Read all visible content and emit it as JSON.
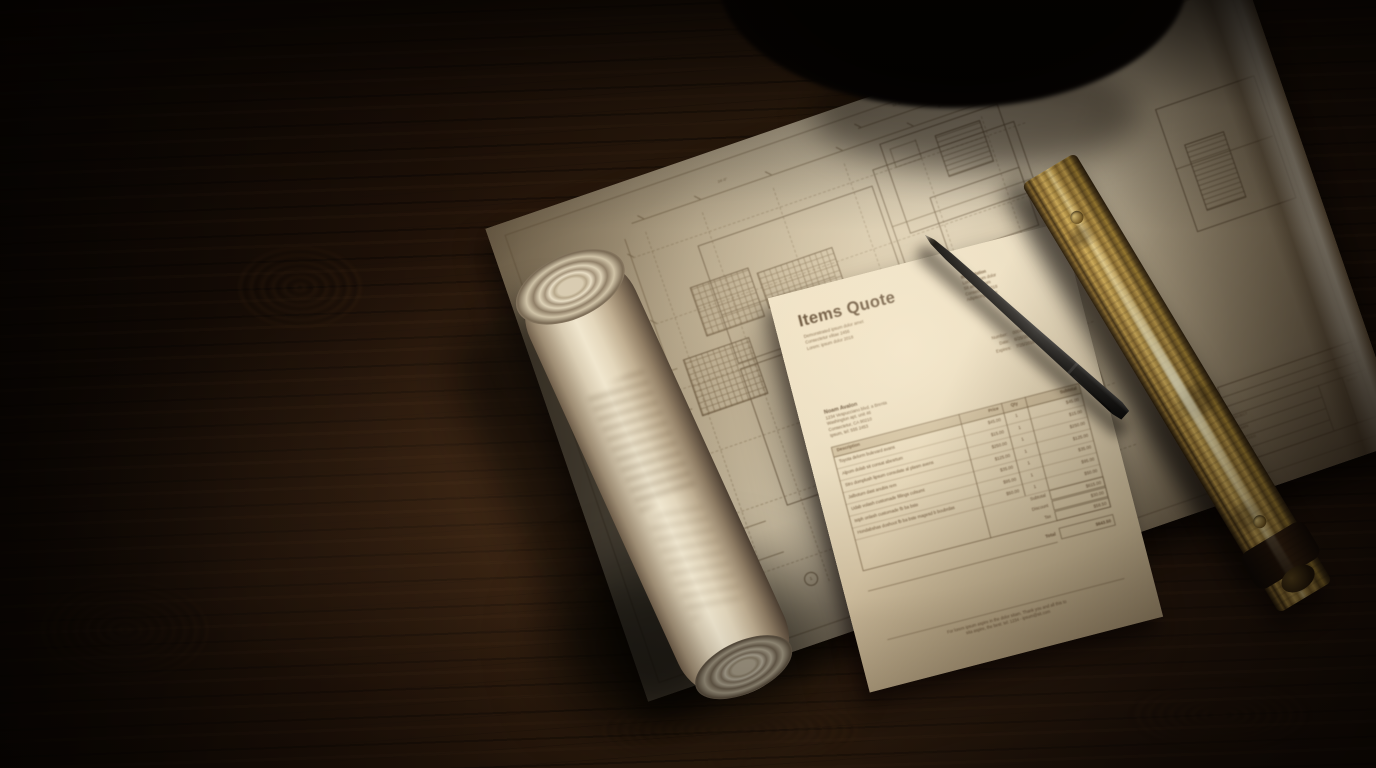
{
  "quote": {
    "title": "Items Quote",
    "company_lines": [
      "Demonstrated ipsum dolor amet",
      "Consectetur elitae 2456",
      "Lorem: ipsum dolor 2018"
    ],
    "corner_lines": [
      "Items station",
      "Lorem ipsum dolor",
      "Sit amet elitum",
      "Consectetur 2018",
      "Adipiscing alume"
    ],
    "meta_rows": [
      {
        "label": "Number:",
        "value": "00042"
      },
      {
        "label": "Date:",
        "value": "6/25/2018"
      },
      {
        "label": "Expires:",
        "value": "7/25/2018"
      }
    ],
    "bill_to": {
      "name": "Noam Avalon",
      "lines": [
        "1234 Vespucciano blvd. a Brenta",
        "Washington apt. unit 46",
        "Consectetur, CA 90210",
        "Ipsum, tel: 555 2453"
      ]
    },
    "table": {
      "headers": {
        "description": "Description",
        "price": "Price",
        "qty": "Qty",
        "subtotal": "Subtotal"
      },
      "items": [
        {
          "description": "Toyota delorm bulevard avans",
          "price": "$45.00",
          "qty": "1",
          "amount": "$45.00"
        },
        {
          "description": "Alpom dolab sit consat abesrtum",
          "price": "$15.00",
          "qty": "1",
          "amount": "$15.00"
        },
        {
          "description": "Stro domplush lipsum consolate al plasm avens",
          "price": "$250.00",
          "qty": "1",
          "amount": "$250.00"
        },
        {
          "description": "Jalboturn dast anubis rem",
          "price": "$125.00",
          "qty": "1",
          "amount": "$125.00"
        },
        {
          "description": "Udab volash customade fillings colsumt",
          "price": "$35.00",
          "qty": "1",
          "amount": "$35.00"
        },
        {
          "description": "Istph onlash customade fb ba bste",
          "price": "$95.00",
          "qty": "1",
          "amount": "$95.00"
        },
        {
          "description": "Hondabshas doshoot fb ba bste magesd b boubrdas",
          "price": "$50.00",
          "qty": "1",
          "amount": "$50.00"
        }
      ],
      "summary": [
        {
          "label": "Subtotal",
          "value": "$615.00"
        },
        {
          "label": "Discount",
          "value": "$30.00"
        },
        {
          "label": "Tax",
          "value": "$58.50"
        }
      ],
      "total": {
        "label": "Total",
        "value": "$643.50"
      }
    },
    "footer_lines": [
      "For lorem ipsum aspire in the dolor sitam. Thank you and all this to",
      "sita aspire, the best: tel: 1234 - ipsum@sit.com"
    ]
  },
  "blueprint": {
    "grid_bubbles": [
      "B",
      "C",
      "5",
      "6",
      "1"
    ],
    "dimension_labels": [
      "24'-0\"",
      "12'-6\"",
      "8'-4\"",
      "16'-0\"",
      "9'-2\""
    ],
    "title_block_labels": [
      "PROJECT",
      "DRAWN",
      "CHECKED",
      "SCALE",
      "SHEET"
    ]
  },
  "colors": {
    "ink": "#5d4730",
    "paper": "#ece0c5",
    "blueprint_paper": "#cfc2a8",
    "brass": "#c9a44e",
    "wood": "#24150a"
  }
}
